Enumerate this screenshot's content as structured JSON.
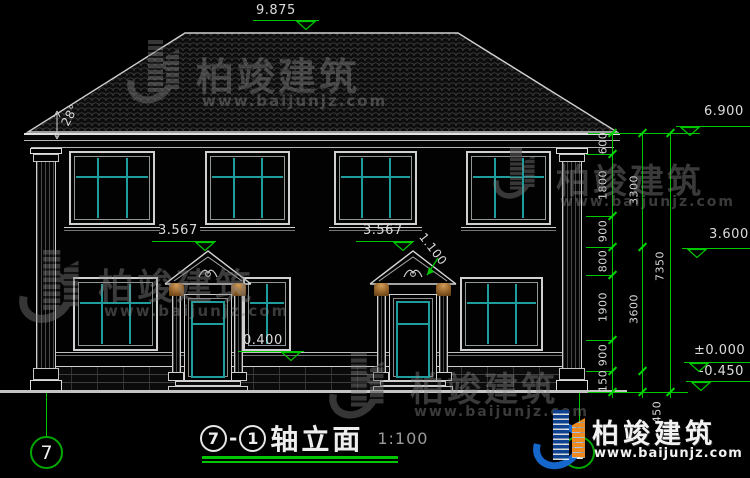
{
  "drawing": {
    "axis_from": "7",
    "dash": "-",
    "axis_to": "1",
    "name": "轴立面",
    "scale": "1:100"
  },
  "levels": {
    "ridge": "9.875",
    "eave": "6.900",
    "floor2": "3.600",
    "zero": "±0.000",
    "ground": "-0.450",
    "pediment_left": "3.567",
    "pediment_right": "3.567",
    "plinth": "0.400",
    "pediment_height": "1.100",
    "roof_angle": "28°"
  },
  "dim_chain": {
    "col1": [
      "600",
      "1800",
      "900",
      "800",
      "1900",
      "900",
      "150"
    ],
    "col2": [
      "3300",
      "3600"
    ],
    "col2_bottom": "450",
    "col3_total": "7350"
  },
  "grid_bubbles": {
    "left": "7",
    "right": "1"
  },
  "watermark": {
    "brand": "柏竣建筑",
    "site": "www.baijunjz.com"
  },
  "logo": {
    "brand": "柏竣建筑",
    "site": "www.baijunjz.com"
  },
  "colors": {
    "dimension_green": "#00c800",
    "mullion_teal": "#1f9c9c",
    "line_white": "#d0d0d0",
    "capital_orange": "#a8753c",
    "logo_blue": "#1667cb",
    "logo_orange": "#f0891d"
  }
}
